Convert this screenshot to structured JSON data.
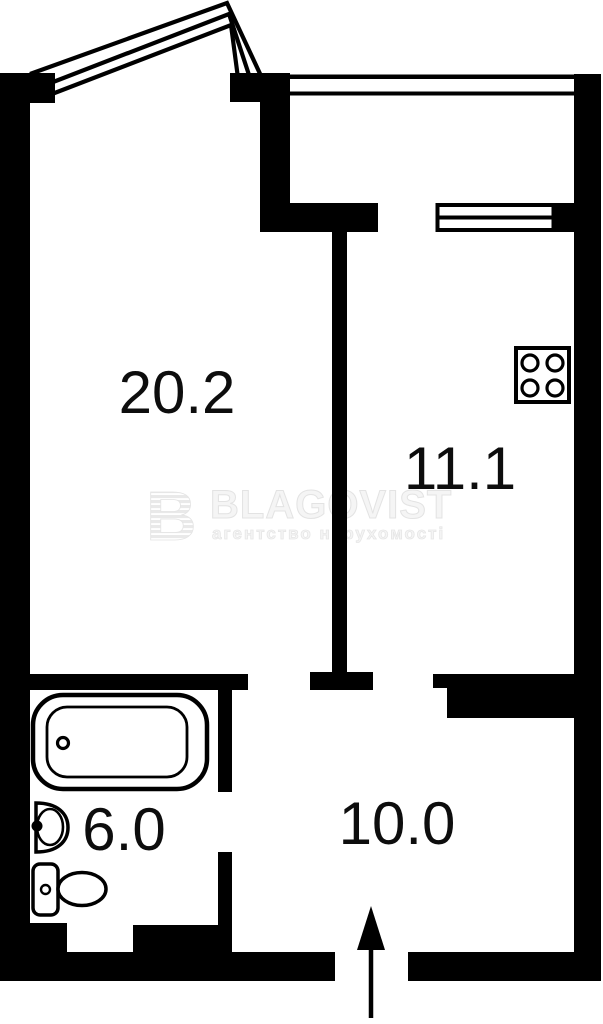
{
  "plan": {
    "type": "apartment-floor-plan",
    "colors": {
      "wall": "#000000",
      "background": "#ffffff",
      "watermark": "#f0f0f0",
      "label": "#0d0d0d"
    },
    "rooms": [
      {
        "id": "living-room",
        "area_label": "20.2"
      },
      {
        "id": "kitchen",
        "area_label": "11.1"
      },
      {
        "id": "bathroom",
        "area_label": "6.0"
      },
      {
        "id": "hallway",
        "area_label": "10.0"
      }
    ],
    "watermark": {
      "logo_letter": "B",
      "brand": "BLAGOVIST",
      "tagline": "агентство нерухомості"
    },
    "icons": [
      "bathtub-icon",
      "sink-icon",
      "toilet-icon",
      "stove-icon",
      "entrance-arrow-icon",
      "window-icon",
      "window-unit-icon",
      "bay-window-icon"
    ]
  }
}
